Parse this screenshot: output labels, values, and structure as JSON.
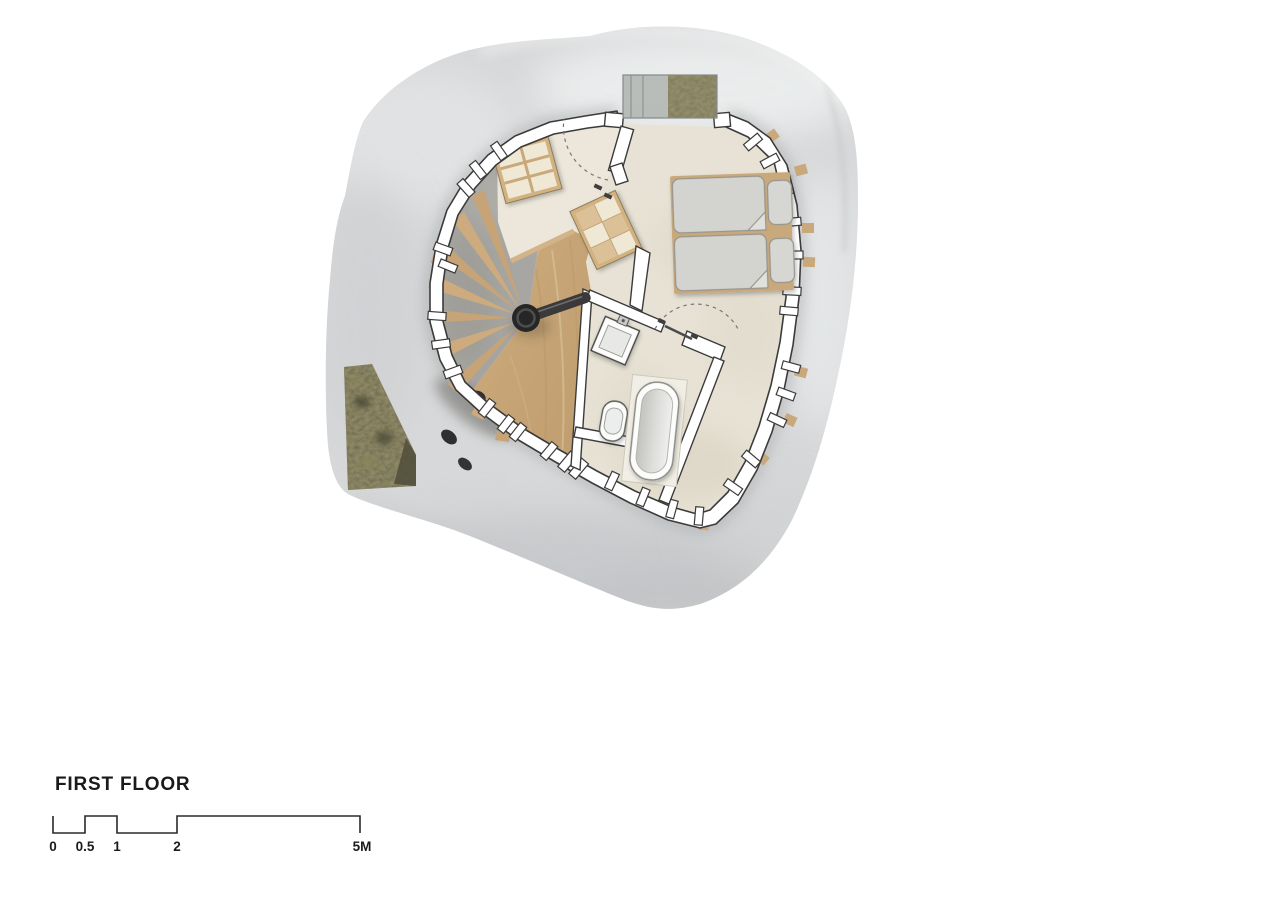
{
  "page": {
    "background_color": "#ffffff"
  },
  "drawing": {
    "title": "FIRST FLOOR",
    "scale_bar": {
      "unit": "M",
      "labels": [
        "0",
        "0.5",
        "1",
        "2",
        "5M"
      ],
      "values_m": [
        0,
        0.5,
        1,
        2,
        5
      ]
    },
    "colors": {
      "shell": "#d9dadb",
      "shell_highlight": "#eef0f0",
      "shell_shadow": "#c6c8ca",
      "wall_fill": "#ffffff",
      "wall_line": "#3b3b3b",
      "floor_cream": "#e8e3d6",
      "floor_landing": "#ece7da",
      "stair_floor_gray": "#a7a6a2",
      "wood": "#c9a87b",
      "plywood": "#d3b282",
      "moss": "#6b654a",
      "glass": "#b3b7b4",
      "bedding_gray": "#d3d4d0",
      "fixture_white": "#fcfcfb",
      "stair_post_black": "#2c2c2c",
      "text": "#1a1a1a"
    },
    "elements": [
      {
        "name": "outer-shell",
        "desc": "organic monolithic shell wall"
      },
      {
        "name": "entry-glazing",
        "desc": "glazed entry panel with moss growth"
      },
      {
        "name": "moss-window",
        "desc": "vegetated opening in shell, west side"
      },
      {
        "name": "spiral-staircase",
        "desc": "black centre post, handrail, radiating timber treads"
      },
      {
        "name": "timber-walkway",
        "desc": "plywood floor fan"
      },
      {
        "name": "storage-shelves",
        "desc": "two plywood storage / shelf units"
      },
      {
        "name": "twin-beds",
        "desc": "two single beds, pillows and folded duvets"
      },
      {
        "name": "bathroom",
        "desc": "wash basin, toilet and bathtub"
      },
      {
        "name": "door-swings",
        "desc": "dashed door swing arcs"
      },
      {
        "name": "window-slits",
        "desc": "small openings piercing the perimeter wall"
      }
    ]
  }
}
